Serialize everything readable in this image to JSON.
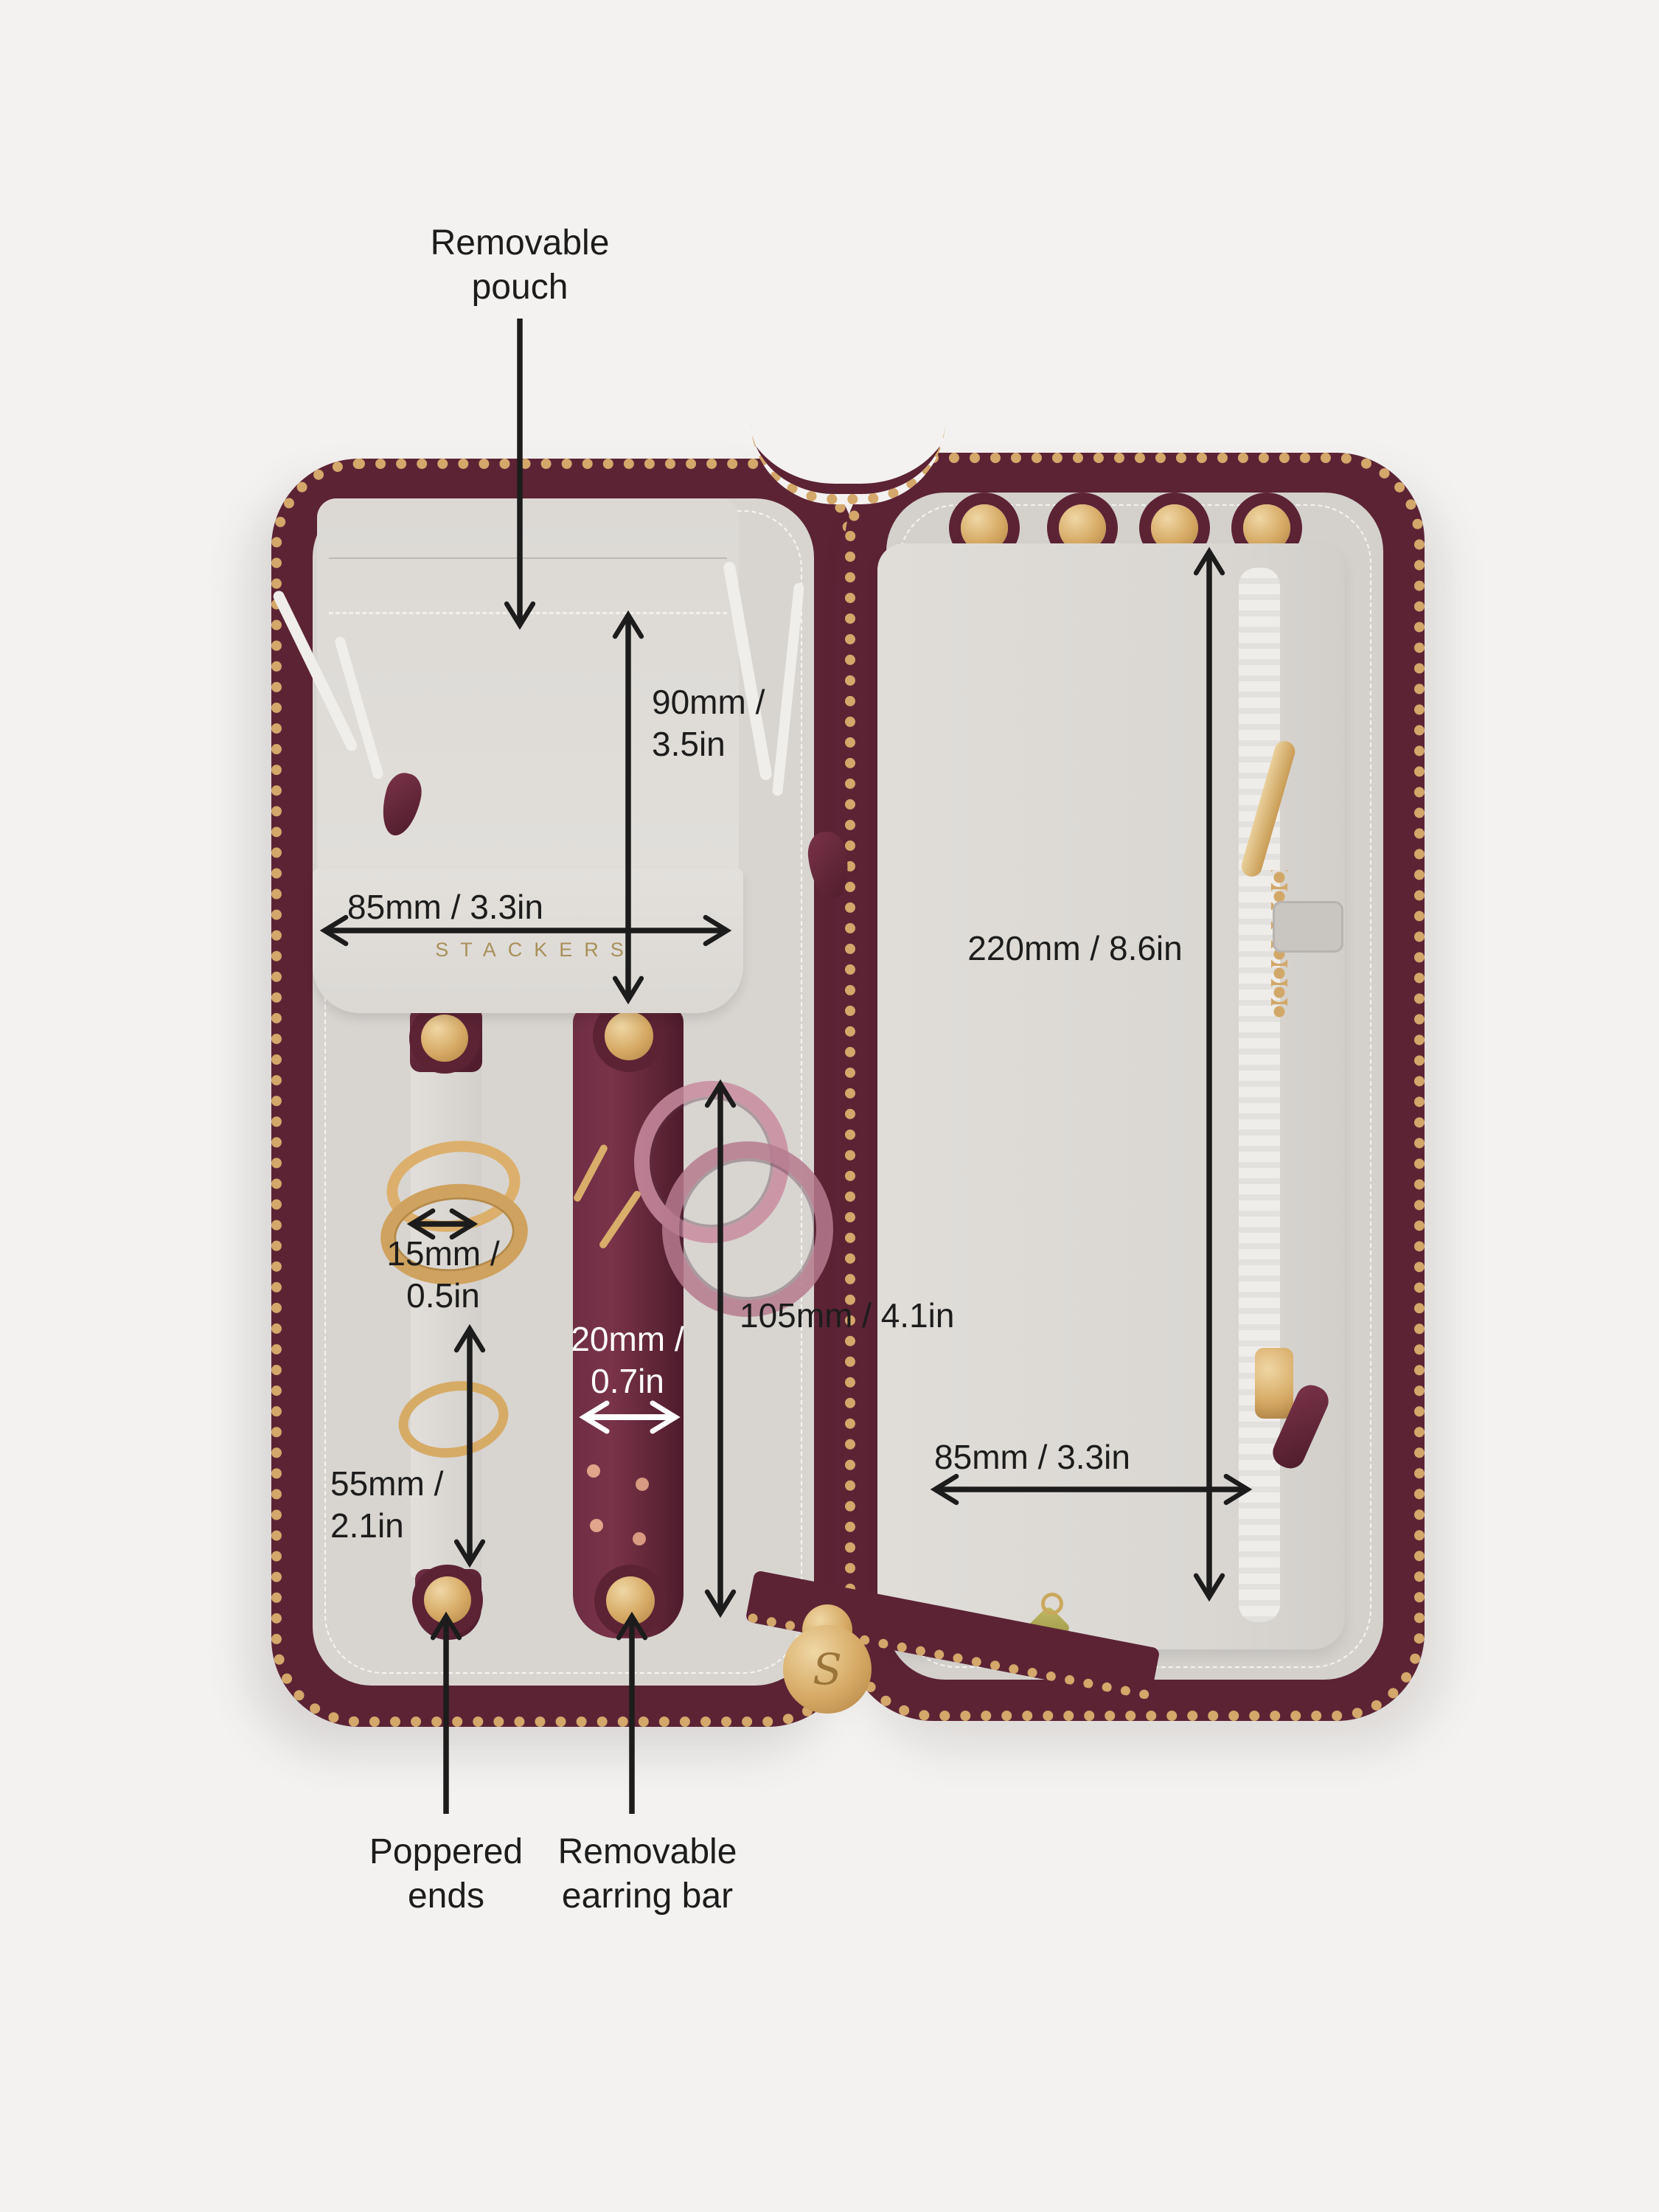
{
  "brand": {
    "name": "STACKERS",
    "initial": "S"
  },
  "annotations": {
    "pouch": {
      "label": "Removable\npouch"
    },
    "pouch_height": {
      "label": "90mm /\n3.5in"
    },
    "pouch_width": {
      "label": "85mm / 3.3in"
    },
    "panel_height": {
      "label": "220mm / 8.6in"
    },
    "ring_strap_width": {
      "label": "15mm /\n0.5in"
    },
    "earring_bar_width": {
      "label": "20mm /\n0.7in"
    },
    "earring_bar_height": {
      "label": "105mm / 4.1in"
    },
    "ring_strap_length": {
      "label": "55mm /\n2.1in"
    },
    "pocket_width": {
      "label": "85mm / 3.3in"
    },
    "poppered_ends": {
      "label": "Poppered\nends"
    },
    "removable_earring_bar": {
      "label": "Removable\nearring bar"
    }
  },
  "colors": {
    "background": "#f3f2f0",
    "leather_burgundy": "#5c2335",
    "interior_grey": "#d8d5d1",
    "panel_grey": "#dedbd7",
    "zipper_gold": "#d4a76a",
    "annotation_black": "#1c1c1c",
    "annotation_white": "#ffffff",
    "brand_gold": "#a98f58"
  }
}
